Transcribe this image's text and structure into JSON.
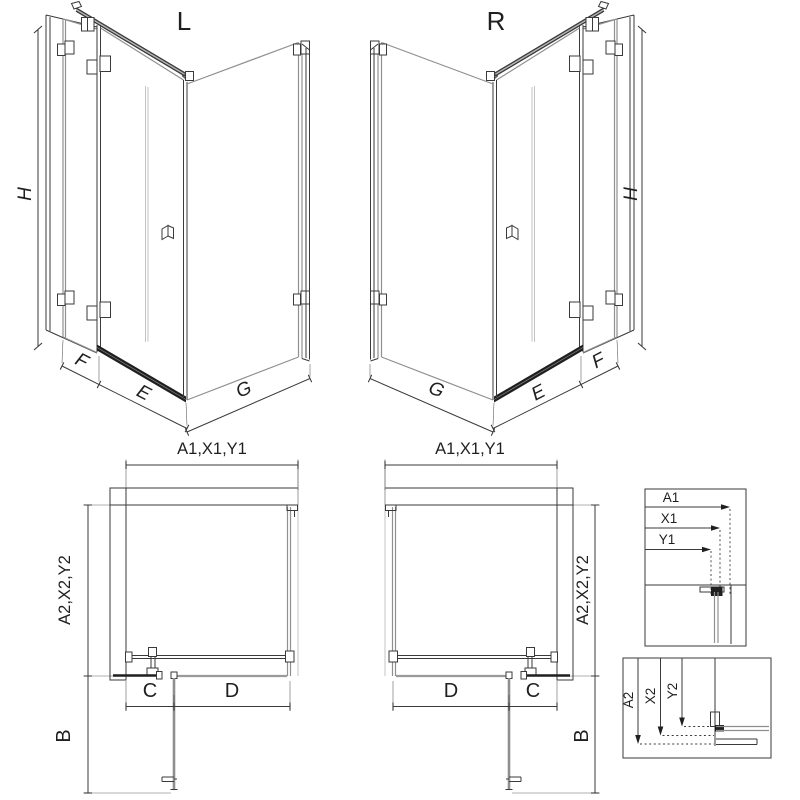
{
  "views": {
    "left": {
      "label": "L",
      "height": "H",
      "fixed_panel": "F",
      "door": "E",
      "side_panel": "G"
    },
    "right": {
      "label": "R",
      "height": "H",
      "fixed_panel": "F",
      "door": "E",
      "side_panel": "G"
    }
  },
  "plans": {
    "left": {
      "width": "A1,X1,Y1",
      "depth": "A2,X2,Y2",
      "fixed_width": "C",
      "door_width": "D",
      "swing": "B"
    },
    "right": {
      "width": "A1,X1,Y1",
      "depth": "A2,X2,Y2",
      "fixed_width": "C",
      "door_width": "D",
      "swing": "B"
    }
  },
  "details": {
    "width_box": {
      "labels": [
        "A1",
        "X1",
        "Y1"
      ]
    },
    "depth_box": {
      "labels": [
        "A2",
        "X2",
        "Y2"
      ]
    }
  },
  "colors": {
    "line": "#3a3a3a",
    "dark": "#1f1f1f",
    "glass": "#8f8f8f",
    "light": "#b5b5b5",
    "hatch": "#6a6a6a",
    "background": "#ffffff"
  }
}
